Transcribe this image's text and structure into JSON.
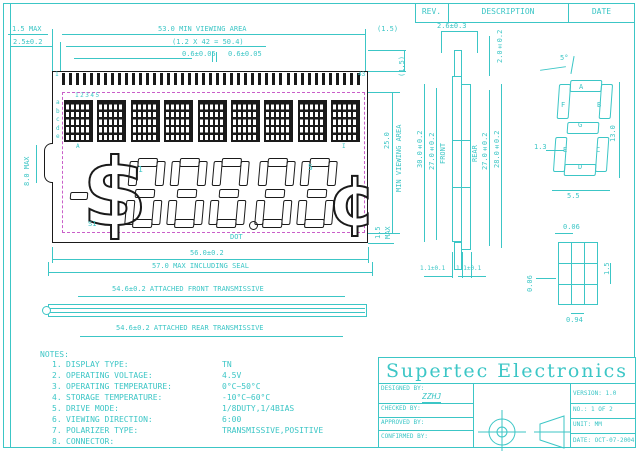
{
  "rev_table": {
    "rev": "REV.",
    "description": "DESCRIPTION",
    "date": "DATE"
  },
  "dims_top": {
    "max15": "1.5 MAX",
    "t25": "2.5±0.2",
    "viewing53": "53.0 MIN VIEWING AREA",
    "pitch": "(1.2 X 42 = 50.4)",
    "p06a": "0.6±0.05",
    "p06b": "0.6±0.05",
    "paren15a": "(1.5)",
    "paren15b": "(1.5)"
  },
  "lcd": {
    "pin_first": "1",
    "pin_last": "43",
    "pin_count": 43,
    "block_count": 9,
    "col_numbers": "12345",
    "row_letters": [
      "a",
      "b",
      "c",
      "d",
      "e"
    ],
    "block_first": "A",
    "block_last": "I",
    "digit_label_first": "1",
    "digit_label_last": "5",
    "sign_label": "S1",
    "dot_label": "DOT",
    "dollar": "$",
    "cent": "¢",
    "left_dim": "8.0 MAX",
    "right_mid_value": "25.0",
    "right_mid_label": "MIN VIEWING AREA",
    "right_bot_value": "1.5",
    "right_bot_label": "MAX"
  },
  "dims_bottom": {
    "w56": "56.0±0.2",
    "w57": "57.0 MAX INCLUDING SEAL",
    "front_pol": "54.6±0.2 ATTACHED FRONT TRANSMISSIVE",
    "rear_pol": "54.6±0.2 ATTACHED REAR TRANSMISSIVE"
  },
  "section": {
    "w26": "2.6±0.3",
    "w20": "2.0±0.2",
    "h30": "30.0±0.2",
    "h27f": "27.0±0.2",
    "front": "FRONT",
    "rear": "REAR",
    "h27r": "27.0±0.2",
    "h28": "28.0±0.2",
    "b11a": "1.1±0.1",
    "b11b": "1.1±0.1"
  },
  "seg_detail": {
    "angle": "5°",
    "a": "A",
    "b": "B",
    "c": "C",
    "d": "D",
    "e": "E",
    "f": "F",
    "g": "G",
    "h": "13.0",
    "w": "5.5",
    "t": "1.3"
  },
  "dot_detail": {
    "gap_top": "0.06",
    "gap_left": "0.06",
    "h": "1.5",
    "w": "0.94"
  },
  "notes": {
    "title": "NOTES:",
    "items": [
      {
        "num": "1.",
        "label": "DISPLAY TYPE:",
        "value": "TN"
      },
      {
        "num": "2.",
        "label": "OPERATING VOLTAGE:",
        "value": "4.5V"
      },
      {
        "num": "3.",
        "label": "OPERATING TEMPERATURE:",
        "value": "0°C~50°C"
      },
      {
        "num": "4.",
        "label": "STORAGE TEMPERATURE:",
        "value": "-10°C~60°C"
      },
      {
        "num": "5.",
        "label": "DRIVE MODE:",
        "value": "1/8DUTY,1/4BIAS"
      },
      {
        "num": "6.",
        "label": "VIEWING DIRECTION:",
        "value": "6:00"
      },
      {
        "num": "7.",
        "label": "POLARIZER TYPE:",
        "value": "TRANSMISSIVE,POSITIVE"
      },
      {
        "num": "8.",
        "label": "CONNECTOR:",
        "value": ""
      }
    ]
  },
  "title_block": {
    "company": "Supertec Electronics",
    "designed_label": "DESIGNED BY:",
    "designed_value": "ZZHJ",
    "checked_label": "CHECKED BY:",
    "approved_label": "APPROVED BY:",
    "confirmed_label": "CONFIRMED BY:",
    "version": "VERSION: 1.0",
    "no": "NO.: 1 OF 2",
    "unit": "UNIT: MM",
    "date": "DATE: OCT-07-2004"
  }
}
